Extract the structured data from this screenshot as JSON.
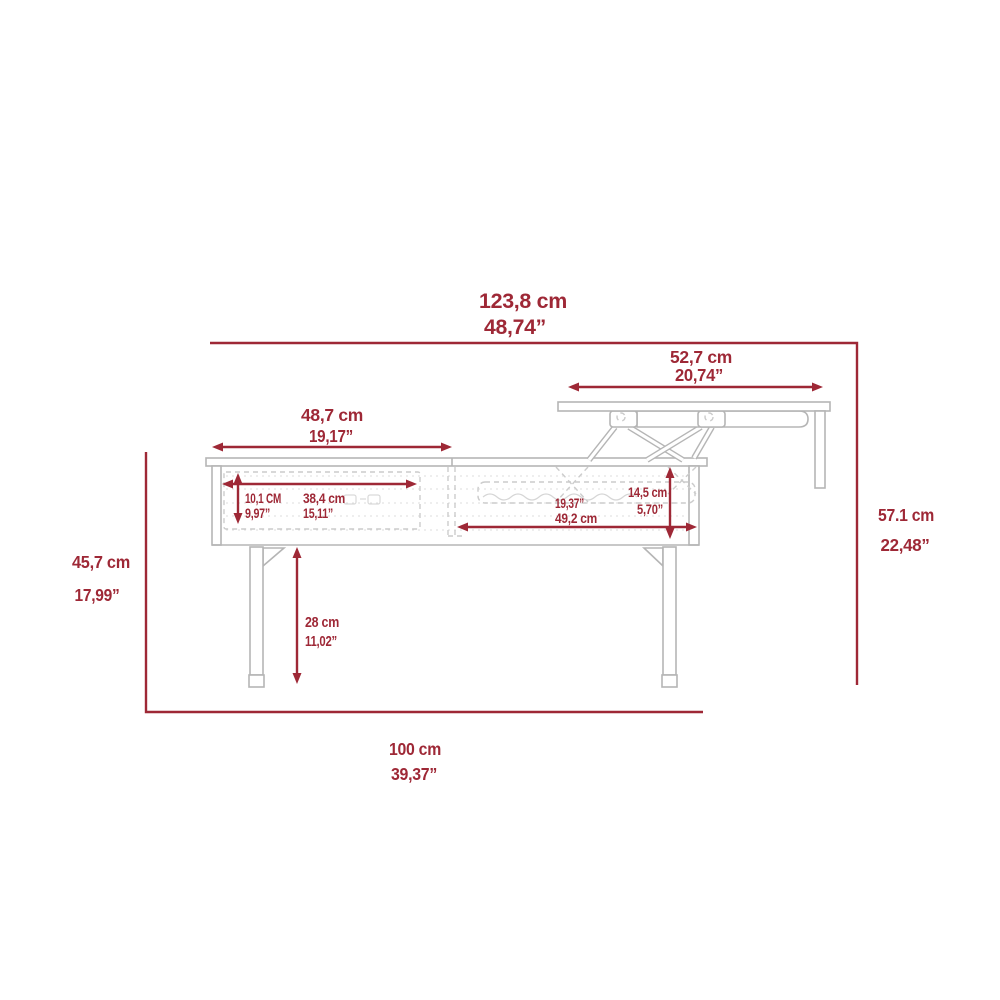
{
  "diagram": {
    "kind": "furniture dimension drawing",
    "subject": "lift-top coffee table, side elevation with raised top"
  },
  "colors": {
    "dimension_red": "#9e2836",
    "drawing_gray": "#b5b5b5",
    "hidden_line_gray": "#d0d0d0",
    "background": "#ffffff"
  },
  "dims": {
    "overall_width": {
      "cm": "123,8 cm",
      "inch": "48,74”"
    },
    "lift_top": {
      "cm": "52,7 cm",
      "inch": "20,74”"
    },
    "fixed_top": {
      "cm": "48,7 cm",
      "inch": "19,17”"
    },
    "drawer_height": {
      "cm": "10,1 CM",
      "inch": "9,97”"
    },
    "drawer_width": {
      "cm": "38,4 cm",
      "inch": "15,11”"
    },
    "storage_width": {
      "inch": "19,37”",
      "cm": "49,2 cm"
    },
    "lift_rise": {
      "cm": "14,5 cm",
      "inch": "5,70”"
    },
    "leg_height": {
      "cm": "28 cm",
      "inch": "11,02”"
    },
    "body_height": {
      "cm": "45,7 cm",
      "inch": "17,99”"
    },
    "total_height": {
      "cm": "57.1 cm",
      "inch": "22,48”"
    },
    "base_width": {
      "cm": "100 cm",
      "inch": "39,37”"
    }
  }
}
